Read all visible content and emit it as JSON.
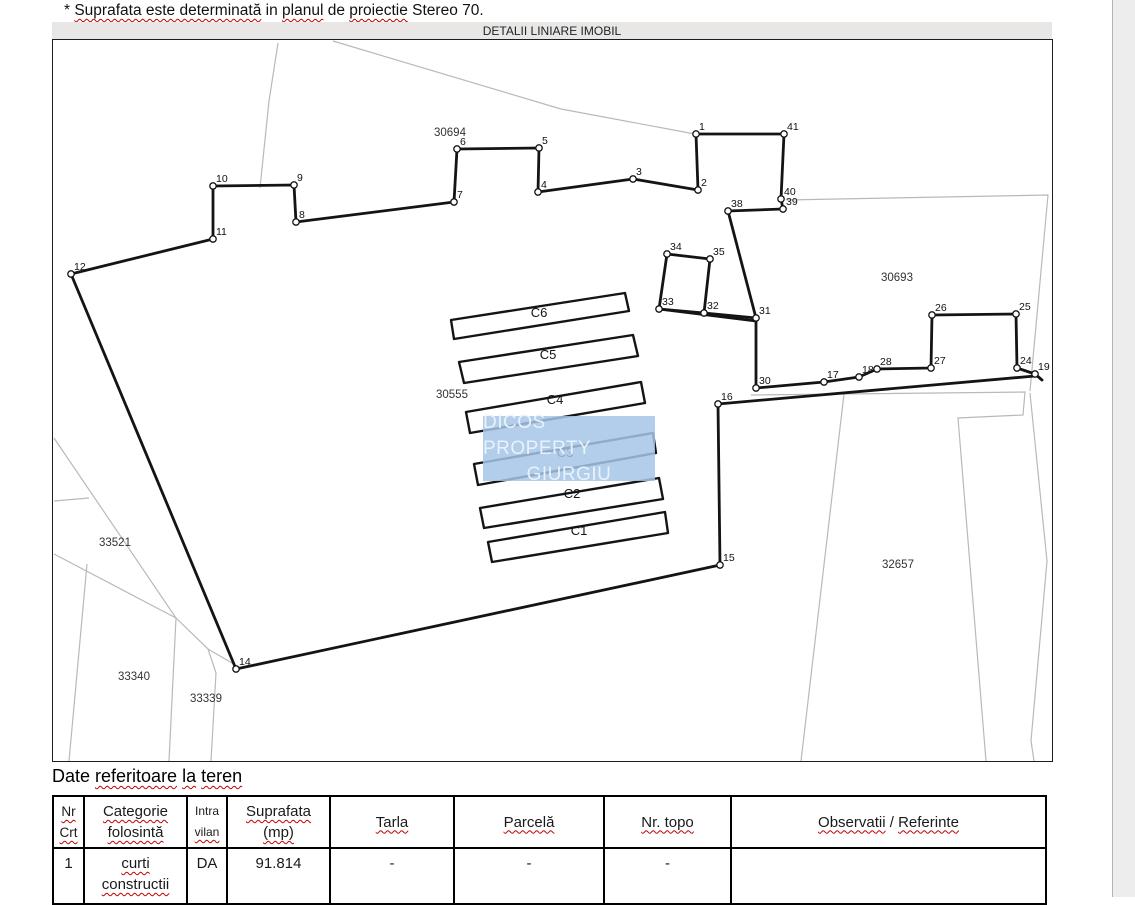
{
  "note": {
    "prefix": "* ",
    "wavy1": "Suprafata este determinată",
    "mid1": " in ",
    "wavy2": "planul",
    "mid2": " de ",
    "wavy3": "proiectie",
    "suffix": " Stereo 70."
  },
  "map": {
    "title": "DETALII LINIARE IMOBIL",
    "watermark": {
      "line1": "DICOS PROPERTY",
      "line2": "GIURGIU",
      "bg_color": "#a6c6e6"
    },
    "parcel_labels": [
      {
        "label": "30694",
        "x": 449,
        "y": 135
      },
      {
        "label": "30693",
        "x": 896,
        "y": 280
      },
      {
        "label": "30555",
        "x": 451,
        "y": 397
      },
      {
        "label": "33521",
        "x": 114,
        "y": 545
      },
      {
        "label": "33340",
        "x": 133,
        "y": 679
      },
      {
        "label": "33339",
        "x": 205,
        "y": 701
      },
      {
        "label": "32657",
        "x": 897,
        "y": 567
      }
    ],
    "building_labels": [
      {
        "label": "C6",
        "x": 538,
        "y": 316
      },
      {
        "label": "C5",
        "x": 547,
        "y": 358
      },
      {
        "label": "C4",
        "x": 554,
        "y": 403
      },
      {
        "label": "C3",
        "x": 564,
        "y": 456
      },
      {
        "label": "C2",
        "x": 571,
        "y": 497
      },
      {
        "label": "C1",
        "x": 578,
        "y": 534
      }
    ],
    "vertices": [
      {
        "n": "1",
        "x": 695,
        "y": 133
      },
      {
        "n": "2",
        "x": 697,
        "y": 189
      },
      {
        "n": "3",
        "x": 632,
        "y": 178
      },
      {
        "n": "4",
        "x": 537,
        "y": 191
      },
      {
        "n": "5",
        "x": 538,
        "y": 147
      },
      {
        "n": "6",
        "x": 456,
        "y": 148
      },
      {
        "n": "7",
        "x": 453,
        "y": 201
      },
      {
        "n": "8",
        "x": 295,
        "y": 221
      },
      {
        "n": "9",
        "x": 293,
        "y": 184
      },
      {
        "n": "10",
        "x": 212,
        "y": 185
      },
      {
        "n": "11",
        "x": 212,
        "y": 238
      },
      {
        "n": "12",
        "x": 70,
        "y": 273
      },
      {
        "n": "14",
        "x": 235,
        "y": 668
      },
      {
        "n": "15",
        "x": 719,
        "y": 564
      },
      {
        "n": "16",
        "x": 717,
        "y": 403
      },
      {
        "n": "17",
        "x": 823,
        "y": 381
      },
      {
        "n": "18",
        "x": 858,
        "y": 376
      },
      {
        "n": "19",
        "x": 1034,
        "y": 373
      },
      {
        "n": "24",
        "x": 1016,
        "y": 367
      },
      {
        "n": "25",
        "x": 1015,
        "y": 313
      },
      {
        "n": "26",
        "x": 931,
        "y": 314
      },
      {
        "n": "27",
        "x": 930,
        "y": 367
      },
      {
        "n": "28",
        "x": 876,
        "y": 368
      },
      {
        "n": "30",
        "x": 755,
        "y": 387
      },
      {
        "n": "31",
        "x": 755,
        "y": 317
      },
      {
        "n": "32",
        "x": 703,
        "y": 312
      },
      {
        "n": "33",
        "x": 658,
        "y": 308
      },
      {
        "n": "34",
        "x": 666,
        "y": 253
      },
      {
        "n": "35",
        "x": 709,
        "y": 258
      },
      {
        "n": "38",
        "x": 727,
        "y": 210
      },
      {
        "n": "39",
        "x": 782,
        "y": 208
      },
      {
        "n": "40",
        "x": 780,
        "y": 198
      },
      {
        "n": "41",
        "x": 783,
        "y": 133
      }
    ]
  },
  "section": {
    "heading_plain": "Date ",
    "heading_wavy1": "referitoare",
    "sp1": " ",
    "heading_wavy2": "la",
    "sp2": " ",
    "heading_wavy3": "teren"
  },
  "table": {
    "headers": {
      "c1l1": "Nr",
      "c1l2": "Crt",
      "c2l1": "Categorie",
      "c2l2": "folosintă",
      "c3l1": "Intra",
      "c3l2": "vilan",
      "c4l1": "Suprafata",
      "c4l2": "(mp)",
      "c5": "Tarla",
      "c6": "Parcelă",
      "c7": "Nr. topo",
      "c8a": "Observatii",
      "c8sep": " / ",
      "c8b": "Referinte"
    },
    "row": {
      "nr": "1",
      "cat_l1": "curti",
      "cat_l2": "constructii",
      "intravilan": "DA",
      "suprafata": "91.814",
      "tarla": "-",
      "parcela": "-",
      "nr_topo": "-",
      "observatii": ""
    }
  },
  "colors": {
    "squiggle": "#c00000",
    "neighbor_line": "#b9b9b9",
    "boundary_line": "#141414",
    "title_bar_bg": "#e8e7e6",
    "right_strip_bg": "#ededed"
  }
}
